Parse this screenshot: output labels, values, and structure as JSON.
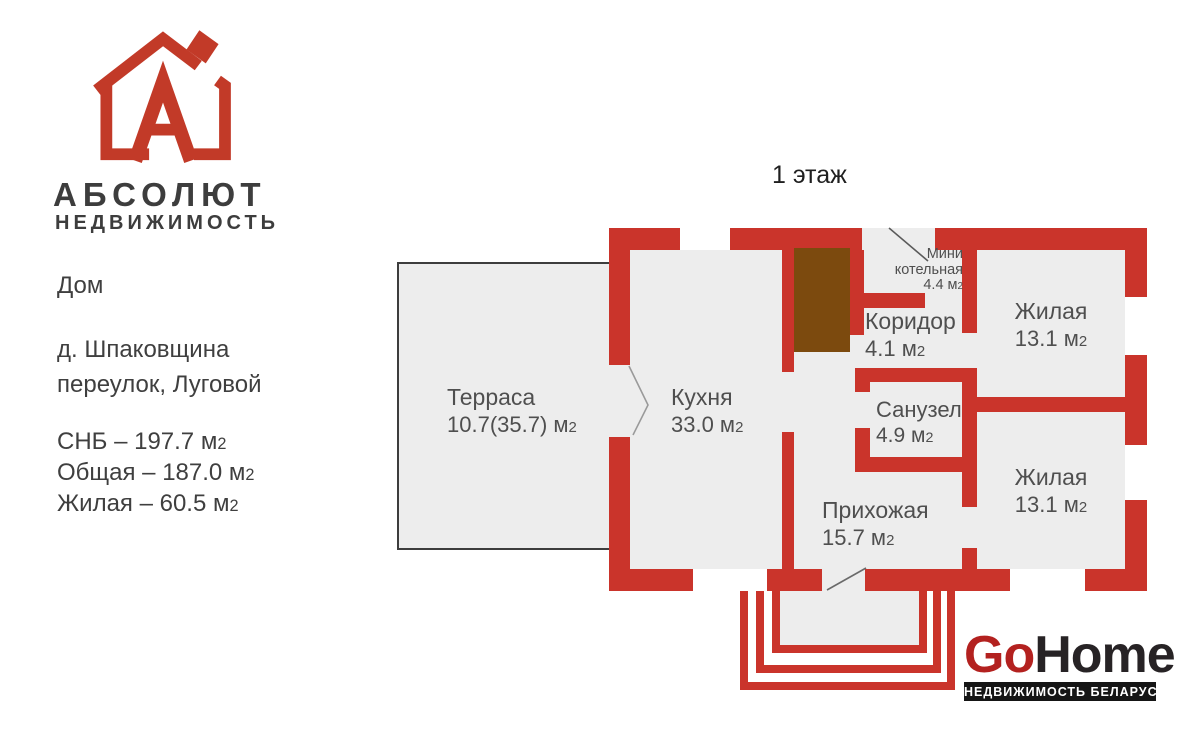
{
  "colors": {
    "wall_red": "#ca342b",
    "boiler_brown": "#7c4a0e",
    "floor_gray": "#ededed",
    "brand_dark": "#3d3d3d",
    "gohome_red": "#b3211f",
    "gohome_dark": "#272325"
  },
  "sidebar": {
    "brand_title": "АБСОЛЮТ",
    "brand_subtitle": "НЕДВИЖИМОСТЬ",
    "listing_type": "Дом",
    "address_line1": "д. Шпаковщина",
    "address_line2": "переулок, Луговой",
    "stats": [
      {
        "text": "СНБ – 197.7 м",
        "sub": "2"
      },
      {
        "text": "Общая – 187.0 м",
        "sub": "2"
      },
      {
        "text": "Жилая – 60.5 м",
        "sub": "2"
      }
    ]
  },
  "plan": {
    "floor_title": "1 этаж",
    "rooms": [
      {
        "name": "Терраса",
        "area": "10.7(35.7) м",
        "sub": "2"
      },
      {
        "name": "Кухня",
        "area": "33.0 м",
        "sub": "2"
      },
      {
        "name_line1": "Мини",
        "name_line2": "котельная",
        "area": "4.4 м",
        "sub": "2"
      },
      {
        "name": "Коридор",
        "area": "4.1 м",
        "sub": "2"
      },
      {
        "name": "Жилая",
        "area": "13.1 м",
        "sub": "2"
      },
      {
        "name": "Санузел",
        "area": "4.9 м",
        "sub": "2"
      },
      {
        "name": "Жилая",
        "area": "13.1 м",
        "sub": "2"
      },
      {
        "name": "Прихожая",
        "area": "15.7 м",
        "sub": "2"
      }
    ]
  },
  "footer": {
    "logo_red_part": "Go",
    "logo_dark_part": "Home",
    "tagline": "НЕДВИЖИМОСТЬ БЕЛАРУСИ"
  }
}
